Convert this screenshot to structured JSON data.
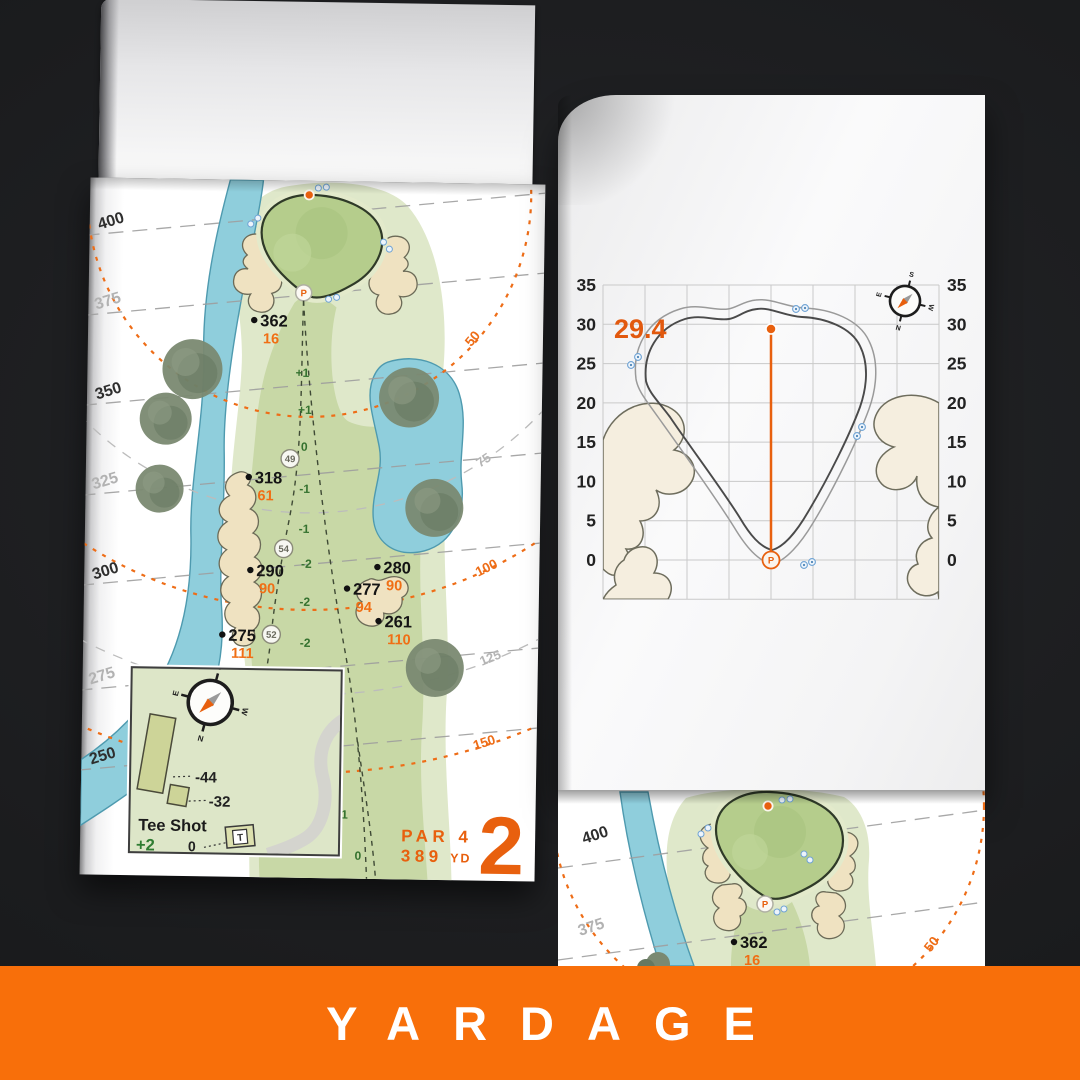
{
  "banner": {
    "label": "YARDAGE"
  },
  "colors": {
    "background": "#1B1C1E",
    "banner_orange": "#F86F0A",
    "accent_orange": "#E8600E",
    "fairway": "#C8D8A6",
    "rough": "#DFE8CA",
    "putting_green": "#B5CD8C",
    "water": "#8FCEDC",
    "sand": "#EFE2C1",
    "slope_text": "#35722F"
  },
  "left_page": {
    "hole_number": "2",
    "par": "PAR 4",
    "yardage": "389",
    "yardage_unit": "YD",
    "contours": [
      "400",
      "375",
      "350",
      "325",
      "300",
      "275",
      "250"
    ],
    "arcs": [
      "50",
      "75",
      "100",
      "125",
      "150"
    ],
    "markers": [
      {
        "yards": "362",
        "to_front": "16"
      },
      {
        "yards": "318",
        "to_front": "61"
      },
      {
        "yards": "290",
        "to_front": "90"
      },
      {
        "yards": "275",
        "to_front": "111"
      },
      {
        "yards": "280",
        "to_front": "90"
      },
      {
        "yards": "277",
        "to_front": "94"
      },
      {
        "yards": "261",
        "to_front": "110"
      }
    ],
    "slopes": [
      "+1",
      "+1",
      "0",
      "-1",
      "-1",
      "-2",
      "-2",
      "-2",
      "-2",
      "-1",
      "-1",
      "0"
    ],
    "waypoints": [
      "49",
      "54",
      "52"
    ],
    "pin_label": "P",
    "inset": {
      "title": "Tee Shot",
      "score": "+2",
      "labels": [
        "-44",
        "-32",
        "0"
      ],
      "tee_marker": "T"
    },
    "compass": {
      "n": "N",
      "s": "S",
      "e": "E",
      "w": "W"
    }
  },
  "right_page": {
    "green_depth": "29.4",
    "y_ticks": [
      "35",
      "30",
      "25",
      "20",
      "15",
      "10",
      "5",
      "0"
    ],
    "pin_label": "P",
    "compass": {
      "n": "N",
      "s": "S",
      "e": "E",
      "w": "W"
    }
  },
  "next_page": {
    "contours": [
      "400",
      "375"
    ],
    "marker": {
      "yards": "362",
      "to_front": "16"
    },
    "arc": "50",
    "pin_label": "P"
  },
  "chart_data": {
    "type": "line",
    "title": "",
    "y_ticks": [
      35,
      30,
      25,
      20,
      15,
      10,
      5,
      0
    ],
    "grid": true,
    "grid_step_yards": 5,
    "green_depth_yards": 29.4,
    "pin": {
      "depth_yards": 29.4
    }
  }
}
